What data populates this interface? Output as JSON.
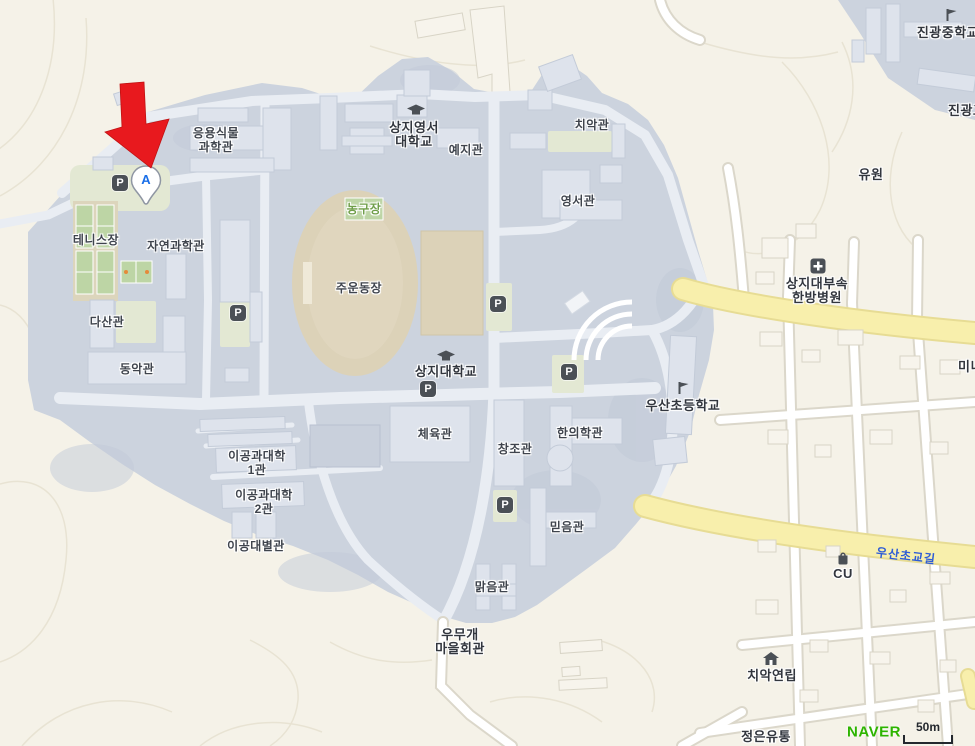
{
  "colors": {
    "campus": "#ccd3de",
    "campus-texture": "#c2cad8",
    "campus-building": "#dee3ec",
    "campus-building-stroke": "#c3cbd8",
    "offmap-bg": "#f5f2e8",
    "offmap-building": "#f7f4ec",
    "offmap-building-stroke": "#d8d4c6",
    "green-patch": "#e3e8d3",
    "court-green": "#bdd5a5",
    "court-surround": "#dcd5bc",
    "road-white": "#ffffff",
    "road-casing": "#dbd7ca",
    "campus-road": "#e9edf3",
    "road-yellow": "#f8efac",
    "road-yellow-casing": "#e7dc94",
    "field-tan": "#dcd2b8",
    "field-tan2": "#e3dac3",
    "contour": "#e8e3d3",
    "label-dark": "#3f444d",
    "label-green": "#6f9e49",
    "road-label-blue": "#2e5cd6",
    "poi-icon-dark": "#4b5056",
    "marker-red": "#e8191e",
    "marker-blue": "#1a6fe8",
    "naver-green": "#2db400"
  },
  "marker": {
    "letter": "A"
  },
  "parking_label": "P",
  "labels": {
    "applied_plant_1": "응용식물",
    "applied_plant_2": "과학관",
    "yeji_hall": "예지관",
    "chiak_hall": "치악관",
    "yeongseo_hall": "영서관",
    "tennis_court": "테니스장",
    "natural_science_hall": "자연과학관",
    "basketball_court": "농구장",
    "main_stadium": "주운동장",
    "dasan_hall": "다산관",
    "dongak_hall": "동악관",
    "engineering_1_1": "이공과대학",
    "engineering_1_2": "1관",
    "engineering_2_1": "이공과대학",
    "engineering_2_2": "2관",
    "engineering_annex": "이공대별관",
    "gym_hall": "체육관",
    "changjo_hall": "창조관",
    "korean_medicine_hall": "한의학관",
    "mideum_hall": "믿음관",
    "malgeum_hall": "맑음관"
  },
  "pois": {
    "sangji_yeongseo_1": "상지영서",
    "sangji_yeongseo_2": "대학교",
    "sangji_univ": "상지대학교",
    "usan_elementary": "우산초등학교",
    "jingwang_middle": "진광중학교",
    "jingwang_high_partial": "진광고",
    "hospital_1": "상지대부속",
    "hospital_2": "한방병원",
    "cu_store": "CU",
    "chiak_row_houses": "치악연립",
    "umugae_1": "우무개",
    "umugae_2": "마을회관",
    "jeongeun_dist": "정은유통",
    "yuwon_area": "유원",
    "mini_partial": "미니"
  },
  "roads": {
    "usanchogyo_gil": "우산초교길"
  },
  "footer": {
    "attribution": "NAVER",
    "scale_text": "50m"
  }
}
